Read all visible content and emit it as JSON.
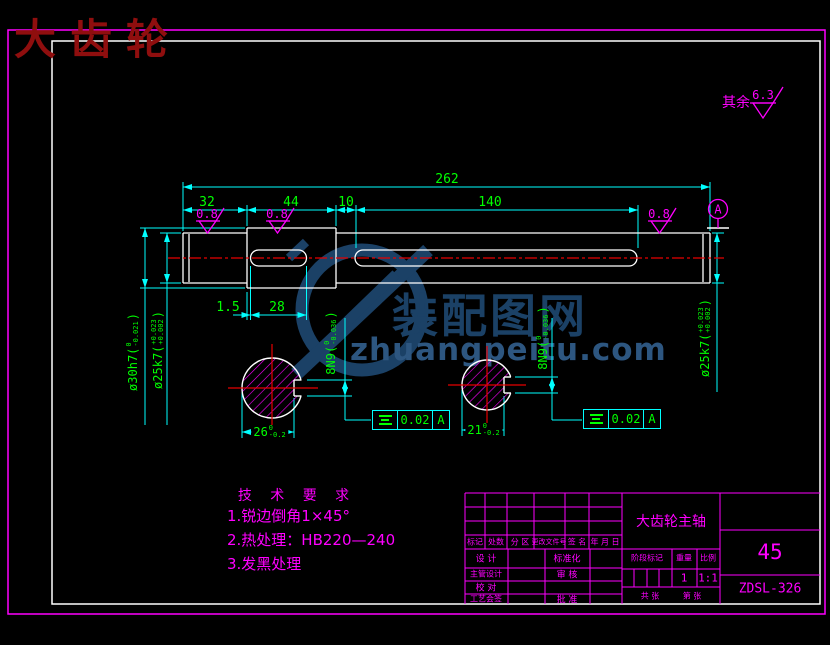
{
  "title": "大齿轮",
  "watermark": {
    "cn": "装配图网",
    "en": "zhuangpeitu.com"
  },
  "surface": {
    "general_prefix": "其余",
    "general_value": "6.3",
    "r1": "0.8",
    "r2": "0.8",
    "r3": "0.8"
  },
  "datum_label": "A",
  "dims": {
    "overall": "262",
    "d32": "32",
    "d44": "44",
    "d10": "10",
    "d140": "140",
    "d15": "1.5",
    "d28": "28"
  },
  "dia30": {
    "main": "ø30h7(",
    "sup": "0",
    "sub": "-0.021",
    "close": ")"
  },
  "dia25L": {
    "main": "ø25k7(",
    "sup": "+0.023",
    "sub": "+0.002",
    "close": ")"
  },
  "dia25R": {
    "main": "ø25k7(",
    "sup": "+0.023",
    "sub": "+0.002",
    "close": ")"
  },
  "key8L": {
    "main": "8N9(",
    "sup": "0",
    "sub": "-0.036",
    "close": ")"
  },
  "key8R": {
    "main": "8N9(",
    "sup": "0",
    "sub": "-0.036",
    "close": ")"
  },
  "w26": {
    "main": "26",
    "sup": "0",
    "sub": "-0.2"
  },
  "w21": {
    "main": "21",
    "sup": "0",
    "sub": "-0.2"
  },
  "fcfL": {
    "value": "0.02",
    "datum": "A"
  },
  "fcfR": {
    "value": "0.02",
    "datum": "A"
  },
  "tech": {
    "heading": "技 术 要 求",
    "item1": "1.锐边倒角1×45°",
    "item2": "2.热处理：HB220—240",
    "item3": "3.发黑处理"
  },
  "tblock": {
    "hdr_mark": "标记",
    "hdr_count": "处数",
    "hdr_zone": "分 区",
    "hdr_file": "更改文件号",
    "hdr_sign": "签 名",
    "hdr_date": "年 月 日",
    "design": "设 计",
    "standard": "标准化",
    "chief_design": "主管设计",
    "audit": "审 核",
    "proof": "校 对",
    "process_sign": "工艺会签",
    "approve": "批 准",
    "part_name": "大齿轮主轴",
    "stage_lbl": "阶段标记",
    "weight_lbl": "重量",
    "scale_lbl": "比例",
    "weight": "1",
    "scale": "1:1",
    "sheets": "共 张",
    "sheet_no": "第 张",
    "material": "45",
    "drawing_no": "ZDSL-326"
  },
  "colors": {
    "line_cyan": "#00ffff",
    "text_green": "#00ff00",
    "anno_magenta": "#ff00ff",
    "geom_white": "#ffffff",
    "center_red": "#e60000",
    "title_red": "#8f0e0e",
    "watermark_blue": "#1b4166"
  }
}
